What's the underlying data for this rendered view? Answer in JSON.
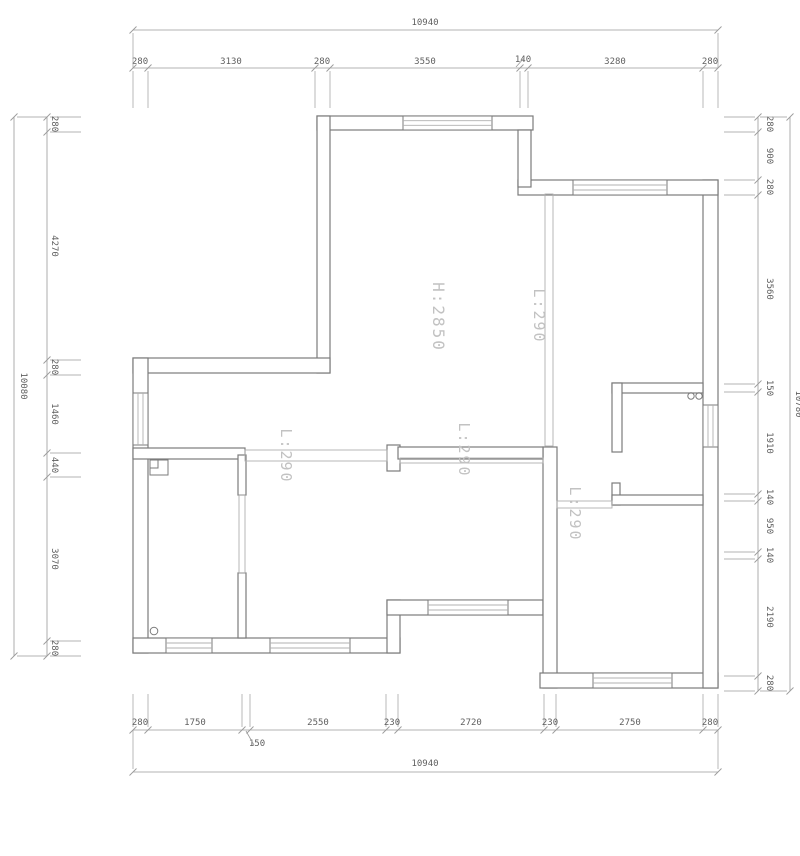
{
  "title": "floor-plan-drawing",
  "colors": {
    "bg": "#ffffff",
    "wall": "#7b7b7b",
    "thin": "#b0b0b0",
    "dim": "#9a9a9a",
    "dimText": "#5f5f5f",
    "label": "#c2c2c2"
  },
  "plan": {
    "walls": [
      {
        "x": 317,
        "y": 116,
        "w": 216,
        "h": 14
      },
      {
        "x": 317,
        "y": 116,
        "w": 13,
        "h": 257
      },
      {
        "x": 133,
        "y": 358,
        "w": 197,
        "h": 15
      },
      {
        "x": 133,
        "y": 358,
        "w": 15,
        "h": 295
      },
      {
        "x": 133,
        "y": 638,
        "w": 267,
        "h": 15
      },
      {
        "x": 387,
        "y": 600,
        "w": 13,
        "h": 53
      },
      {
        "x": 387,
        "y": 600,
        "w": 156,
        "h": 15
      },
      {
        "x": 543,
        "y": 447,
        "w": 14,
        "h": 241
      },
      {
        "x": 540,
        "y": 673,
        "w": 178,
        "h": 15
      },
      {
        "x": 703,
        "y": 180,
        "w": 15,
        "h": 508
      },
      {
        "x": 518,
        "y": 180,
        "w": 200,
        "h": 15
      },
      {
        "x": 518,
        "y": 130,
        "w": 13,
        "h": 57
      },
      {
        "x": 612,
        "y": 383,
        "w": 91,
        "h": 10
      },
      {
        "x": 612,
        "y": 383,
        "w": 10,
        "h": 69
      },
      {
        "x": 133,
        "y": 448,
        "w": 112,
        "h": 11
      },
      {
        "x": 387,
        "y": 445,
        "w": 13,
        "h": 26
      },
      {
        "x": 398,
        "y": 447,
        "w": 145,
        "h": 12
      },
      {
        "x": 238,
        "y": 455,
        "w": 8,
        "h": 40
      },
      {
        "x": 238,
        "y": 573,
        "w": 8,
        "h": 65
      },
      {
        "x": 612,
        "y": 483,
        "w": 8,
        "h": 22
      },
      {
        "x": 612,
        "y": 495,
        "w": 91,
        "h": 10
      }
    ],
    "windows": [
      {
        "x": 403,
        "y": 116,
        "w": 89,
        "h": 14,
        "o": "h"
      },
      {
        "x": 573,
        "y": 180,
        "w": 94,
        "h": 15,
        "o": "h"
      },
      {
        "x": 133,
        "y": 393,
        "w": 15,
        "h": 52,
        "o": "v"
      },
      {
        "x": 703,
        "y": 405,
        "w": 15,
        "h": 42,
        "o": "v"
      },
      {
        "x": 166,
        "y": 638,
        "w": 46,
        "h": 15,
        "o": "h"
      },
      {
        "x": 270,
        "y": 638,
        "w": 80,
        "h": 15,
        "o": "h"
      },
      {
        "x": 428,
        "y": 600,
        "w": 80,
        "h": 15,
        "o": "h"
      },
      {
        "x": 593,
        "y": 673,
        "w": 79,
        "h": 15,
        "o": "h"
      }
    ],
    "beams": [
      {
        "x": 245,
        "y": 450,
        "w": 142,
        "h": 11
      },
      {
        "x": 400,
        "y": 458,
        "w": 143,
        "h": 5
      },
      {
        "x": 545,
        "y": 194,
        "w": 8,
        "h": 252
      },
      {
        "x": 557,
        "y": 501,
        "w": 55,
        "h": 7
      },
      {
        "x": 239,
        "y": 495,
        "w": 6,
        "h": 78
      }
    ],
    "circles": [
      {
        "cx": 691,
        "cy": 396,
        "r": 3.2
      },
      {
        "cx": 699,
        "cy": 396,
        "r": 3.2
      },
      {
        "cx": 154,
        "cy": 631,
        "r": 3.8
      }
    ],
    "fixtures": [
      {
        "x": 150,
        "y": 460,
        "w": 18,
        "h": 15
      },
      {
        "x": 150,
        "y": 460,
        "w": 8,
        "h": 8
      }
    ],
    "labels": [
      {
        "t": "H:2850",
        "x": 433,
        "y": 317,
        "s": 16
      },
      {
        "t": "L:290",
        "x": 534,
        "y": 316,
        "s": 15
      },
      {
        "t": "L:290",
        "x": 281,
        "y": 456,
        "s": 15
      },
      {
        "t": "L:290",
        "x": 459,
        "y": 450,
        "s": 15
      },
      {
        "t": "L:290",
        "x": 570,
        "y": 514,
        "s": 15
      }
    ]
  },
  "dims": {
    "chains": [
      {
        "name": "dim-top-segments",
        "o": "h",
        "line": 68,
        "ext": 40,
        "labOff": -4,
        "ticks": [
          133,
          148,
          315,
          330,
          520,
          528,
          703,
          718
        ],
        "labels": [
          {
            "t": "280",
            "at": 140
          },
          {
            "t": "3130",
            "at": 231
          },
          {
            "t": "280",
            "at": 322
          },
          {
            "t": "3550",
            "at": 425
          },
          {
            "t": "140",
            "at": 523,
            "off": -6
          },
          {
            "t": "3280",
            "at": 615
          },
          {
            "t": "280",
            "at": 710
          }
        ]
      },
      {
        "name": "dim-top-total",
        "o": "h",
        "line": 30,
        "ext": 38,
        "labOff": -5,
        "ticks": [
          133,
          718
        ],
        "labels": [
          {
            "t": "10940",
            "at": 425
          }
        ]
      },
      {
        "name": "dim-bottom-segments",
        "o": "h",
        "line": 730,
        "ext": -36,
        "labOff": -5,
        "ticks": [
          133,
          148,
          242,
          250,
          386,
          398,
          544,
          556,
          703,
          718
        ],
        "labels": [
          {
            "t": "280",
            "at": 140
          },
          {
            "t": "1750",
            "at": 195
          },
          {
            "t": "150",
            "at": 257,
            "off": 16
          },
          {
            "t": "2550",
            "at": 318
          },
          {
            "t": "230",
            "at": 392
          },
          {
            "t": "2720",
            "at": 471
          },
          {
            "t": "230",
            "at": 550
          },
          {
            "t": "2750",
            "at": 630
          },
          {
            "t": "280",
            "at": 710
          }
        ]
      },
      {
        "name": "dim-bottom-total",
        "o": "h",
        "line": 772,
        "ext": -42,
        "labOff": -6,
        "ticks": [
          133,
          718
        ],
        "labels": [
          {
            "t": "10940",
            "at": 425
          }
        ]
      },
      {
        "name": "dim-left-segments",
        "o": "v",
        "line": 47,
        "ext": 34,
        "labOff": 5,
        "ticks": [
          117,
          132,
          360,
          375,
          453,
          477,
          641,
          656
        ],
        "labels": [
          {
            "t": "280",
            "at": 124
          },
          {
            "t": "4270",
            "at": 246
          },
          {
            "t": "280",
            "at": 367
          },
          {
            "t": "1460",
            "at": 414
          },
          {
            "t": "440",
            "at": 465
          },
          {
            "t": "3070",
            "at": 559
          },
          {
            "t": "280",
            "at": 648
          }
        ]
      },
      {
        "name": "dim-left-total",
        "o": "v",
        "line": 14,
        "ext": 33,
        "labOff": 7,
        "ticks": [
          117,
          656
        ],
        "labels": [
          {
            "t": "10080",
            "at": 386
          }
        ]
      },
      {
        "name": "dim-right-segments",
        "o": "v",
        "line": 758,
        "ext": -34,
        "labOff": 9,
        "ticks": [
          117,
          132,
          180,
          195,
          384,
          392,
          494,
          501,
          552,
          559,
          676,
          691
        ],
        "labels": [
          {
            "t": "280",
            "at": 124
          },
          {
            "t": "900",
            "at": 156
          },
          {
            "t": "280",
            "at": 187
          },
          {
            "t": "3560",
            "at": 289
          },
          {
            "t": "150",
            "at": 388
          },
          {
            "t": "1910",
            "at": 443
          },
          {
            "t": "140",
            "at": 497
          },
          {
            "t": "950",
            "at": 526
          },
          {
            "t": "140",
            "at": 555
          },
          {
            "t": "2190",
            "at": 617
          },
          {
            "t": "280",
            "at": 683
          }
        ]
      },
      {
        "name": "dim-right-total",
        "o": "v",
        "line": 790,
        "ext": -30,
        "labOff": 6,
        "ticks": [
          117,
          691
        ],
        "labels": [
          {
            "t": "10780",
            "at": 404
          }
        ]
      }
    ],
    "leaders": [
      [
        524,
        58,
        516,
        67
      ],
      [
        246,
        731,
        254,
        745
      ]
    ]
  }
}
